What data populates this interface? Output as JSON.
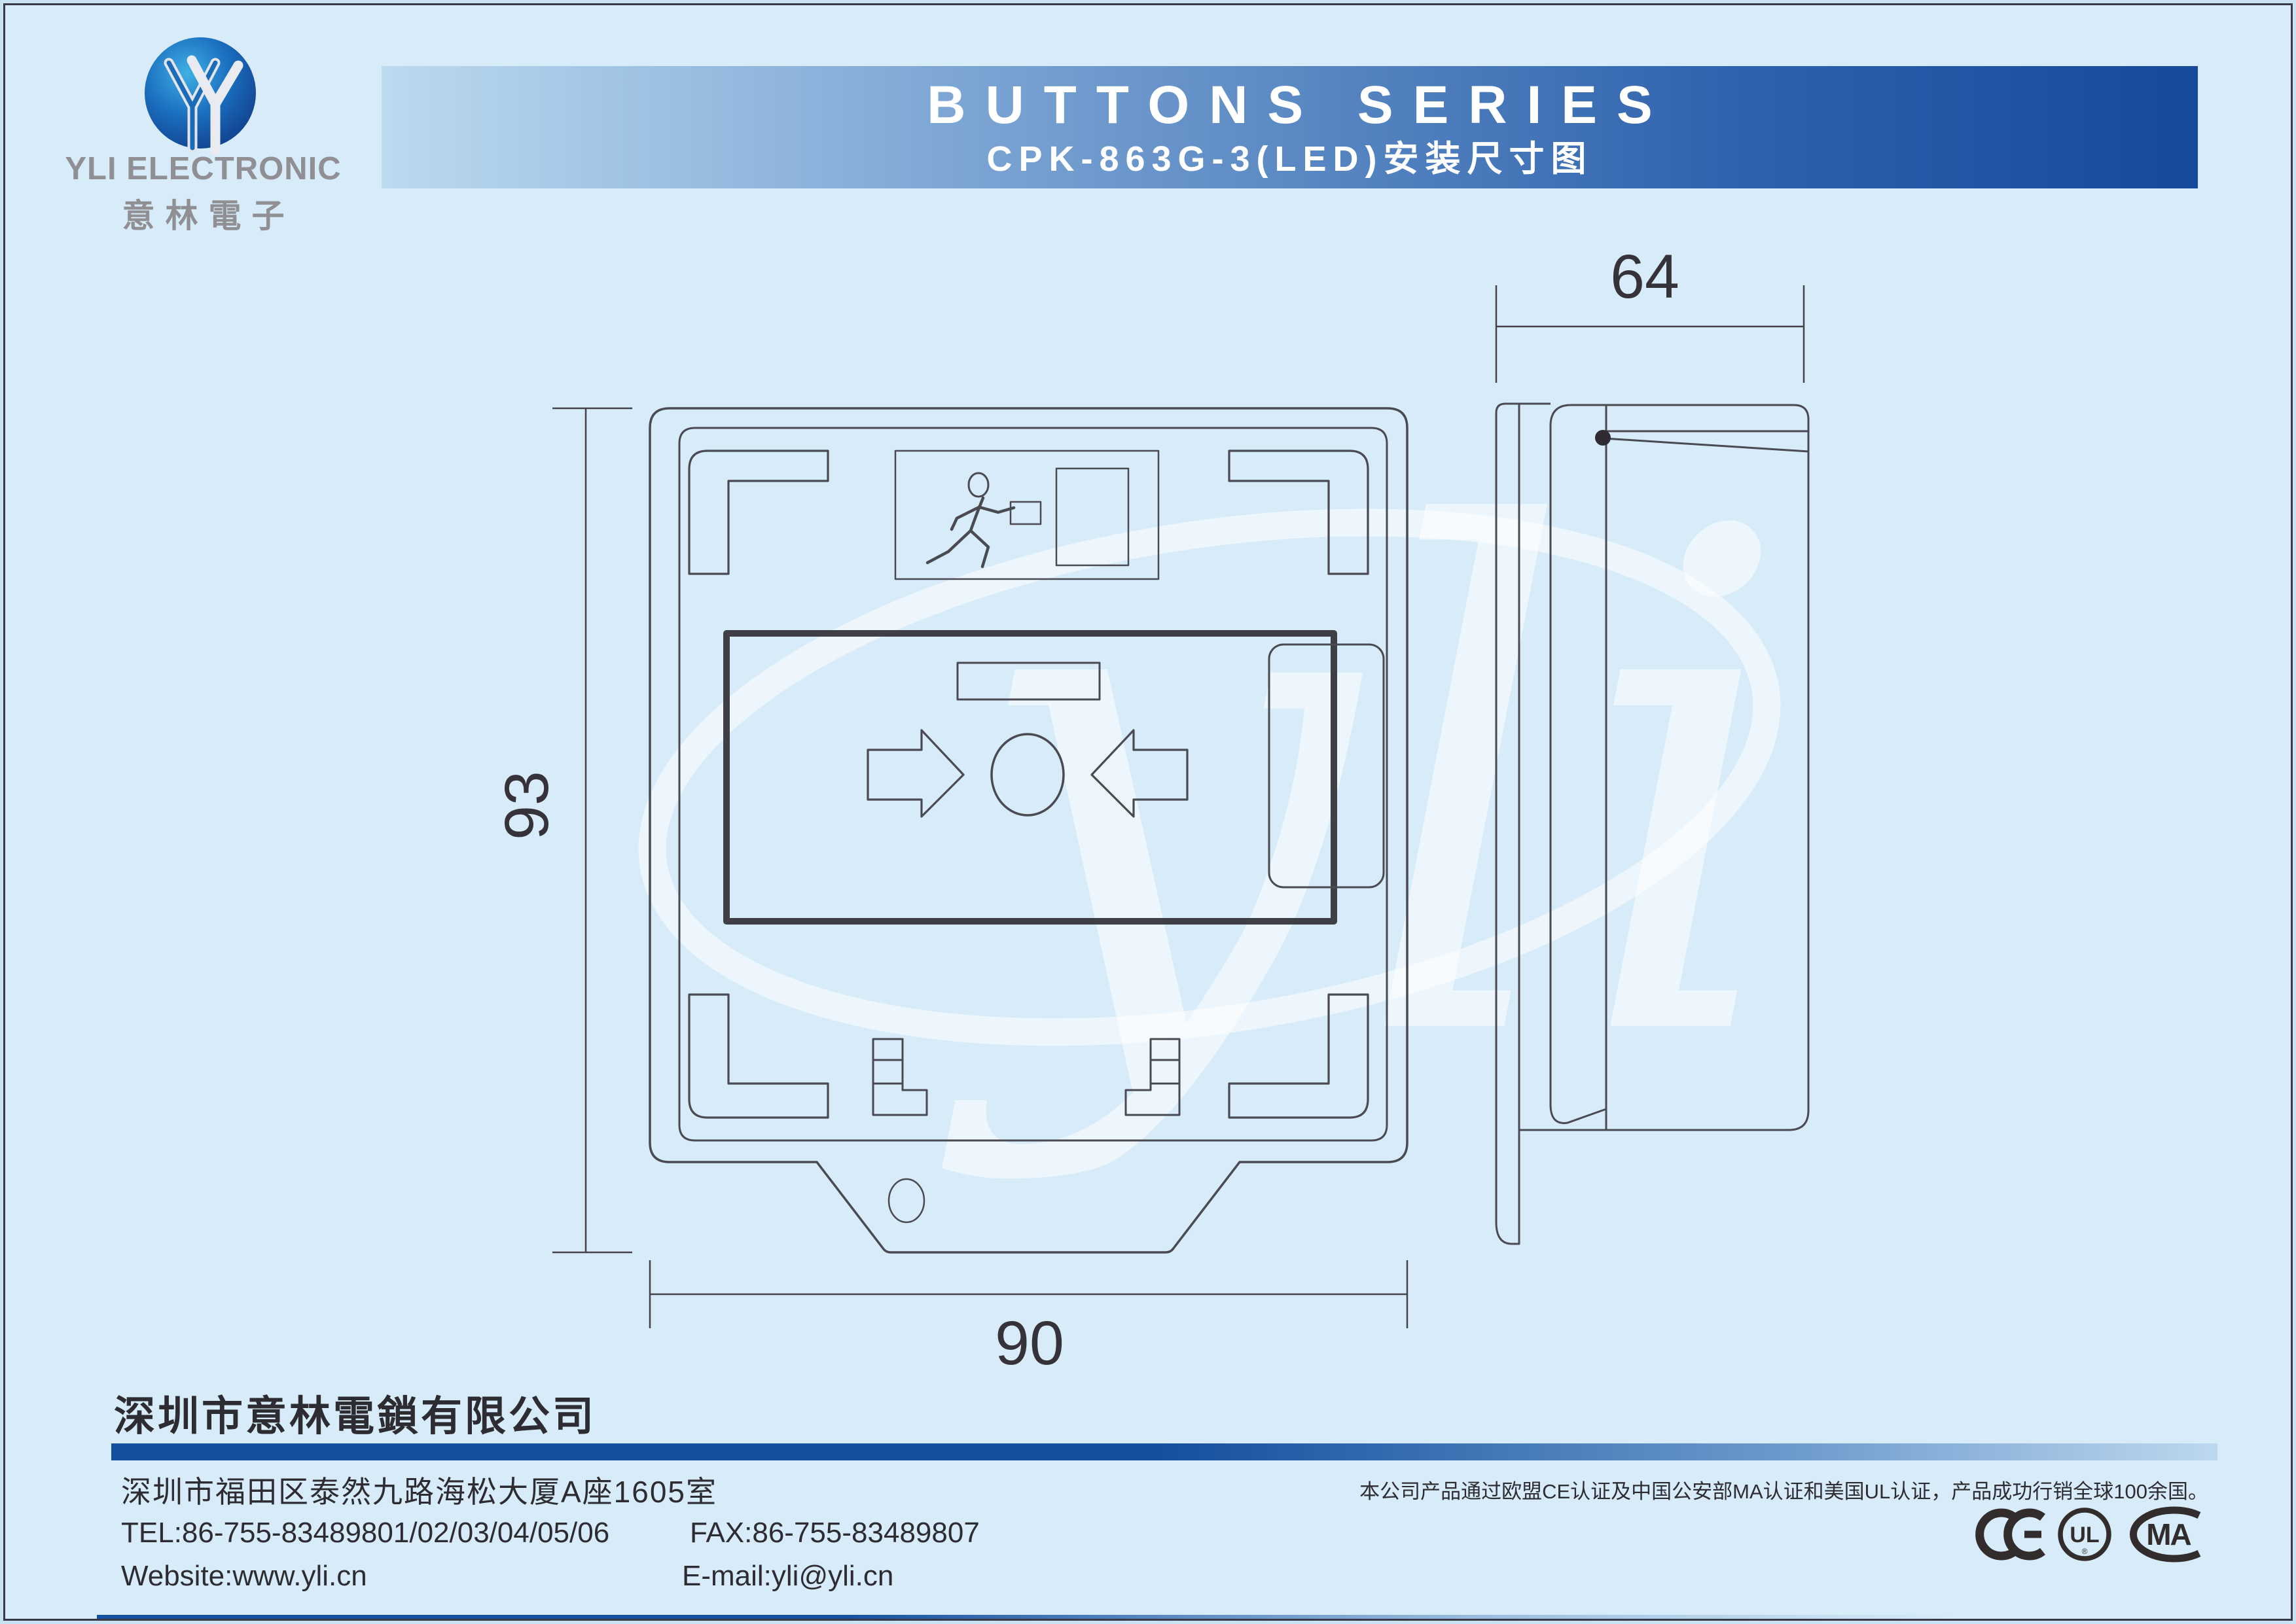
{
  "page": {
    "background": "#d7ecf8",
    "border_color": "#3a3947"
  },
  "header": {
    "logo": {
      "company_en": "YLI ELECTRONIC",
      "company_cn": "意林電子"
    },
    "banner": {
      "title": "BUTTONS SERIES",
      "subtitle": "CPK-863G-3(LED)安装尺寸图",
      "gradient_start": "#bcdaf0",
      "gradient_end": "#17499a",
      "text_color": "#ffffff"
    }
  },
  "drawing": {
    "watermark": "yli",
    "dimensions": {
      "height": "93",
      "width": "90",
      "depth": "64"
    }
  },
  "footer": {
    "company": "深圳市意林電鎖有限公司",
    "address": "深圳市福田区泰然九路海松大厦A座1605室",
    "tel": "TEL:86-755-83489801/02/03/04/05/06",
    "fax": "FAX:86-755-83489807",
    "website": "Website:www.yli.cn",
    "email": "E-mail:yli@yli.cn",
    "certification": "本公司产品通过欧盟CE认证及中国公安部MA认证和美国UL认证，产品成功行销全球100余国。",
    "marks": {
      "ce": "CE",
      "ul": "UL",
      "ul_reg": "®",
      "ma": "MA"
    },
    "accent_color": "#15509e"
  }
}
